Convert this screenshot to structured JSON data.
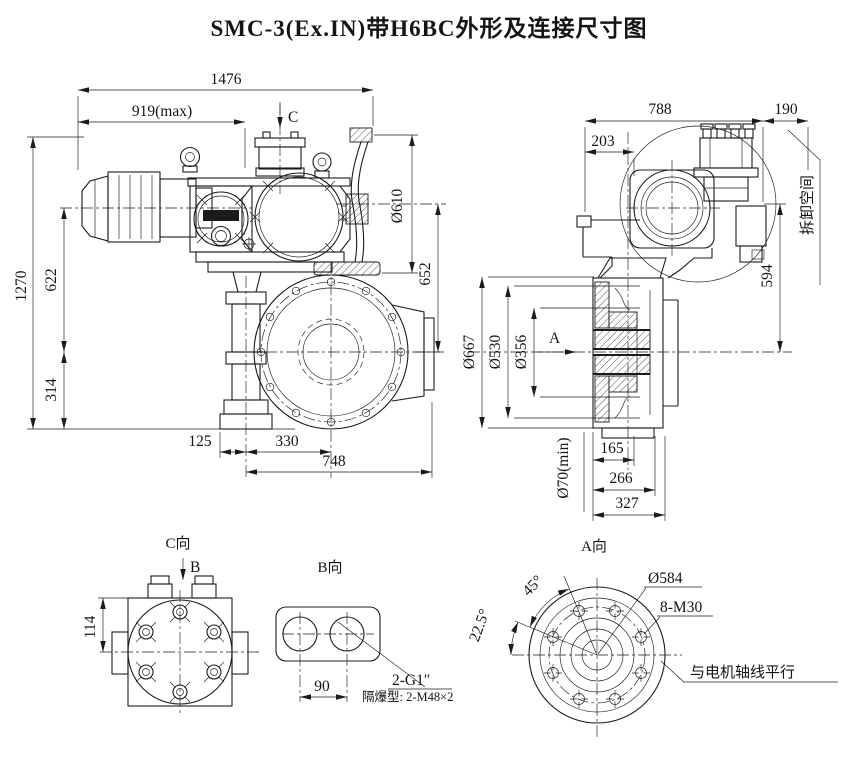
{
  "title": "SMC-3(Ex.IN)带H6BC外形及连接尺寸图",
  "front_view": {
    "d1476": "1476",
    "d919": "919(max)",
    "c_label": "C",
    "d610": "Ø610",
    "d652": "652",
    "d1270": "1270",
    "d622": "622",
    "d314": "314",
    "d125": "125",
    "d330": "330",
    "d748": "748"
  },
  "side_view": {
    "d788": "788",
    "d190": "190",
    "d203": "203",
    "removal_space": "拆卸空间",
    "d594": "594",
    "d667": "Ø667",
    "d530": "Ø530",
    "d356": "Ø356",
    "a_label": "A",
    "d70": "Ø70(min)",
    "d165": "165",
    "d266": "266",
    "d327": "327"
  },
  "view_c": {
    "label": "C向",
    "b_label": "B",
    "d114": "114"
  },
  "view_b": {
    "label": "B向",
    "d90": "90",
    "thread": "2-G1″",
    "note": "隔爆型: 2-M48×2"
  },
  "view_a": {
    "label": "A向",
    "a45": "45°",
    "a225": "22.5°",
    "d584": "Ø584",
    "bolts": "8-M30",
    "note": "与电机轴线平行"
  }
}
